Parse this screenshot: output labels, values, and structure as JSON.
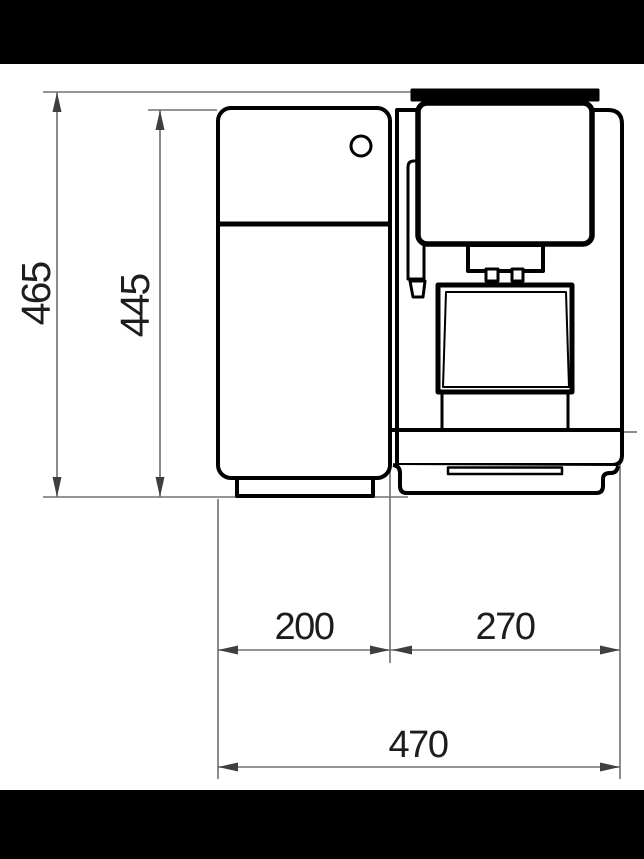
{
  "drawing": {
    "labels": {
      "overall_height": "465",
      "inner_height": "445",
      "rear_depth": "200",
      "front_depth": "270",
      "overall_depth": "470"
    },
    "colors": {
      "background": "#ffffff",
      "letterbox_bar": "#010101",
      "outline": "#000000",
      "dimension_line": "#707070",
      "arrowhead": "#3f3f3f",
      "label_text": "#1d1d1f"
    }
  }
}
